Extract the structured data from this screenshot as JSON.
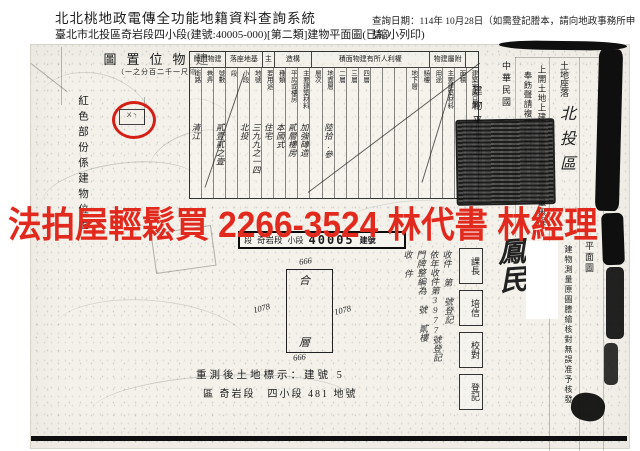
{
  "header": {
    "system_title": "北北桃地政電傳全功能地籍資料查詢系統",
    "query_date": "查詢日期：114年 10月28日（如需登記謄本，請向地政事務所申請。）",
    "document_title": "臺北市北投區奇岩段四小段(建號:40005-000)[第二類]建物平面圖(已縮小列印)"
  },
  "watermark": {
    "text": "法拍屋輕鬆買 2266-3524 林代書 林經理",
    "color": "#e2291d"
  },
  "doc": {
    "map": {
      "title": "建物位置圖",
      "scale": "（縮尺一千二百分之一）",
      "side_note": "紅色部份係建物位置",
      "circle_marks": "ㄨ丶"
    },
    "table": {
      "groups": [
        {
          "label": "建物門牌",
          "span": 3
        },
        {
          "label": "基地座落",
          "span": 3
        },
        {
          "label": "主",
          "span": 1
        },
        {
          "label": "構造",
          "span": 3
        },
        {
          "label": "權利人所有建物面積",
          "span": 10
        },
        {
          "label": "附屬建物",
          "span": 3
        },
        {
          "label": "",
          "span": 1
        }
      ],
      "columns": [
        {
          "h": "街路",
          "v": "清江"
        },
        {
          "h": "巷弄",
          "v": ""
        },
        {
          "h": "號數",
          "v": "貳壹貳之壹"
        },
        {
          "h": "段",
          "v": ""
        },
        {
          "h": "小段",
          "v": "北投"
        },
        {
          "h": "地號",
          "v": "三九九之一四"
        },
        {
          "h": "要用途",
          "v": "住宅"
        },
        {
          "h": "種類",
          "v": "本國式"
        },
        {
          "h": "平房或樓房",
          "v": "貳層樓房"
        },
        {
          "h": "主要建築材料",
          "v": "加強磚造"
        },
        {
          "h": "層次",
          "v": ""
        },
        {
          "h": "地面層",
          "v": "陸拾.參"
        },
        {
          "h": "二層",
          "v": ""
        },
        {
          "h": "三層",
          "v": ""
        },
        {
          "h": "四層",
          "v": ""
        },
        {
          "h": "",
          "v": ""
        },
        {
          "h": "",
          "v": ""
        },
        {
          "h": "",
          "v": ""
        },
        {
          "h": "地下層",
          "v": ""
        },
        {
          "h": "騎樓",
          "v": ""
        },
        {
          "h": "用途",
          "v": ""
        },
        {
          "h": "主要建築材料",
          "v": ""
        },
        {
          "h": "面積",
          "v": ""
        },
        {
          "h": "建築完成日期",
          "v": "民國伍拾捌年拾月日"
        }
      ]
    },
    "plan_strip": {
      "seg1": "段",
      "seg2": "奇岩段",
      "seg3": "小段",
      "number": "40005",
      "seg4": "建號"
    },
    "building_plan": {
      "top": "666",
      "bottom": "666",
      "left": "1078",
      "right": "1078",
      "inner_top": "合",
      "inner_bottom": "層"
    },
    "bottom_note_line1": "重測後土地標示：建號 5",
    "bottom_note_line2": "區 奇岩段　四小段 481 地號",
    "right_panel": {
      "plan_label": "建物平面圖",
      "era_label": "中華民國",
      "statement1": "上開土地上建物位置平面圖經丈量無誤",
      "statement2": "奉飭聲請複丈竣事發給",
      "land_label": "土地座落",
      "land_value": "北投區",
      "verify_note": "建物測量原圖謄繪核對無誤准予核發",
      "plan_label2": "平面圖",
      "signature": "鳳民",
      "date_scribble": "年 月 日"
    },
    "annotations": {
      "handwritten_lines": [
        "收件 第 號登記",
        "依年收件第3977號登記",
        "門牌整編為 號 貳樓",
        "收 件"
      ],
      "stamp_boxes": [
        "課長",
        "培信",
        "校對",
        "登記"
      ]
    }
  }
}
